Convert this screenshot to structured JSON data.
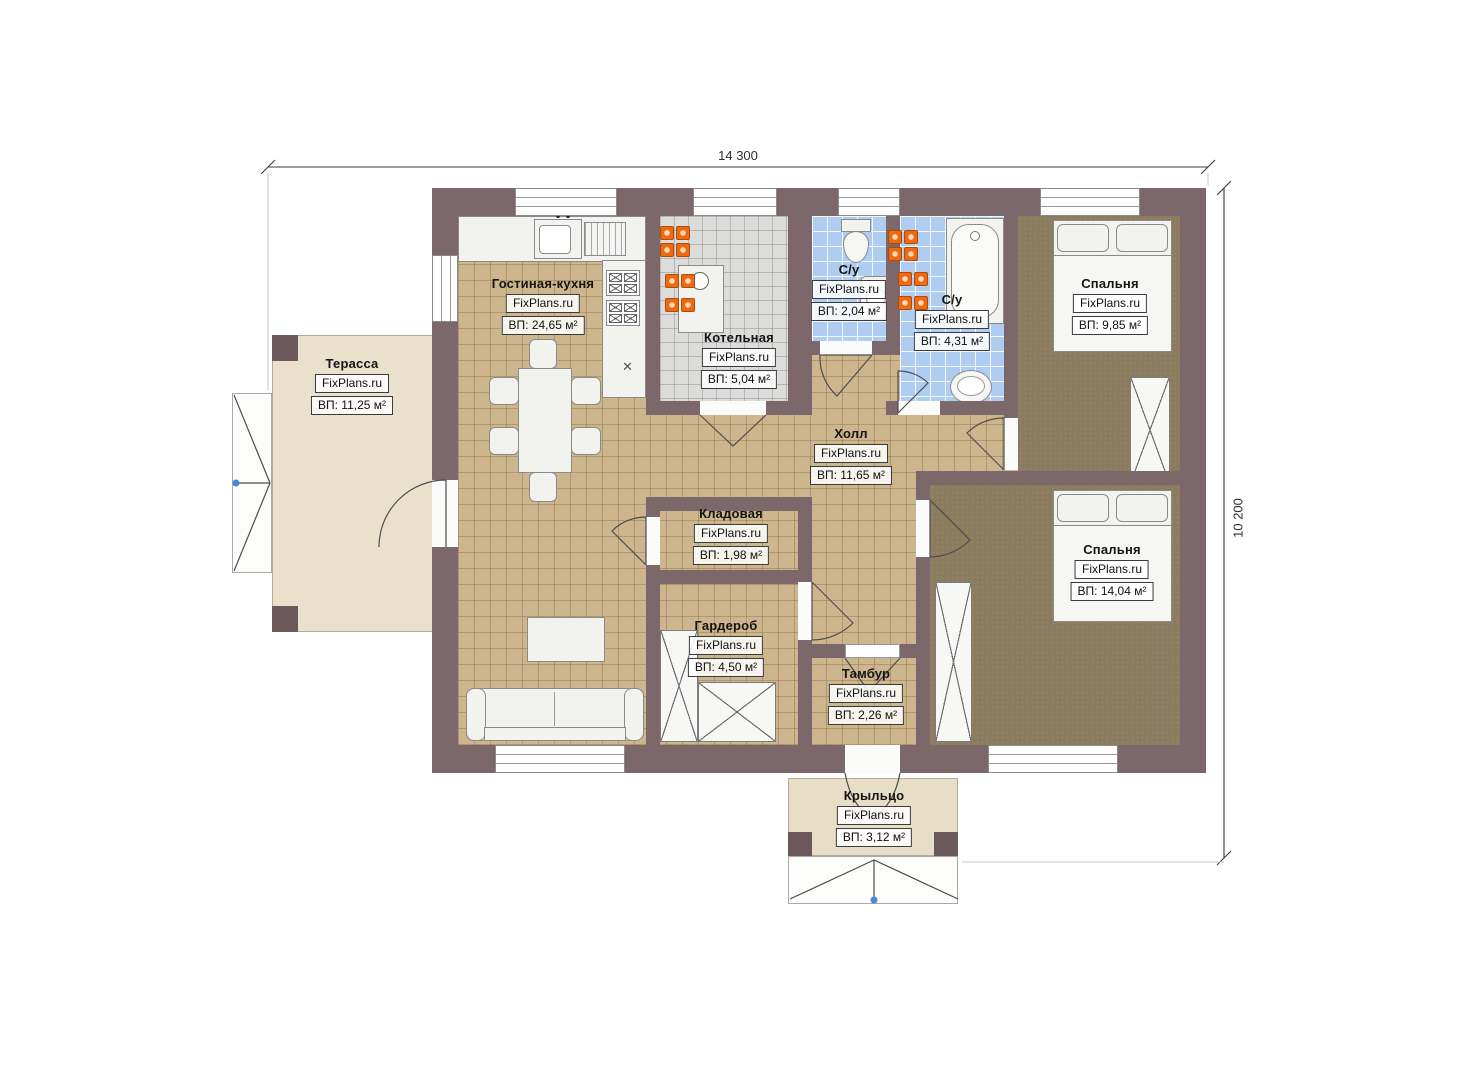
{
  "watermark": "FixPlans.ru",
  "dimensions": {
    "width": "14 300",
    "height": "10 200"
  },
  "rooms": [
    {
      "name": "Гостиная-кухня",
      "area": "ВП: 24,65 м²"
    },
    {
      "name": "Котельная",
      "area": "ВП: 5,04 м²"
    },
    {
      "name": "С/у",
      "area": "ВП: 2,04 м²"
    },
    {
      "name": "С/у",
      "area": "ВП: 4,31 м²"
    },
    {
      "name": "Спальня",
      "area": "ВП: 9,85 м²"
    },
    {
      "name": "Холл",
      "area": "ВП: 11,65 м²"
    },
    {
      "name": "Кладовая",
      "area": "ВП: 1,98 м²"
    },
    {
      "name": "Гардероб",
      "area": "ВП: 4,50 м²"
    },
    {
      "name": "Тамбур",
      "area": "ВП: 2,26 м²"
    },
    {
      "name": "Спальня",
      "area": "ВП: 14,04 м²"
    },
    {
      "name": "Терасса",
      "area": "ВП: 11,25 м²"
    },
    {
      "name": "Крыльцо",
      "area": "ВП: 3,12 м²"
    }
  ]
}
